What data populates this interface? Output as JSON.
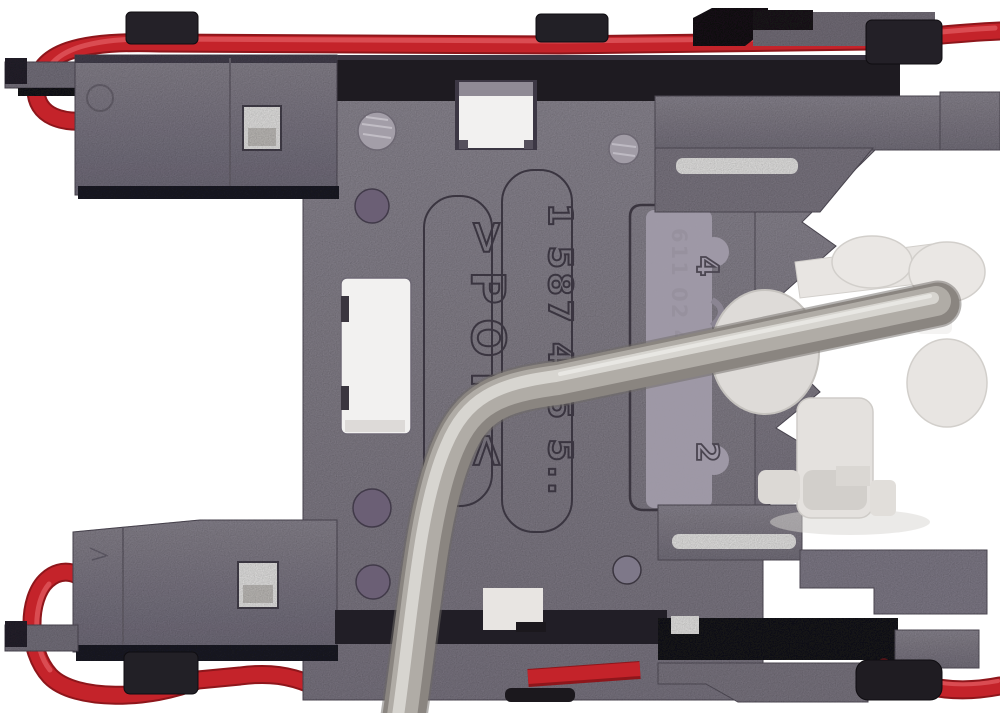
{
  "photo": {
    "markings": {
      "material": ">POM<",
      "part_number": "1 587 415 5..",
      "ink_stamp": "611 02 4",
      "slider_top": "4",
      "slider_bottom": "2"
    },
    "colors": {
      "background": "#ffffff",
      "plastic_gray": "#8b8691",
      "plastic_gray_dark": "#7b7682",
      "plastic_black": "#1e1b21",
      "wire_red": "#c4232a",
      "wire_red_dark": "#8e161b",
      "wire_red_light": "#e0565c",
      "metal_mid": "#b0aca6",
      "metal_dark": "#8a8580",
      "metal_light": "#dcd9d5",
      "white_plastic": "#e8e5e2",
      "hole_purple": "#6b5f75",
      "window_white": "#f2f1f0"
    }
  }
}
